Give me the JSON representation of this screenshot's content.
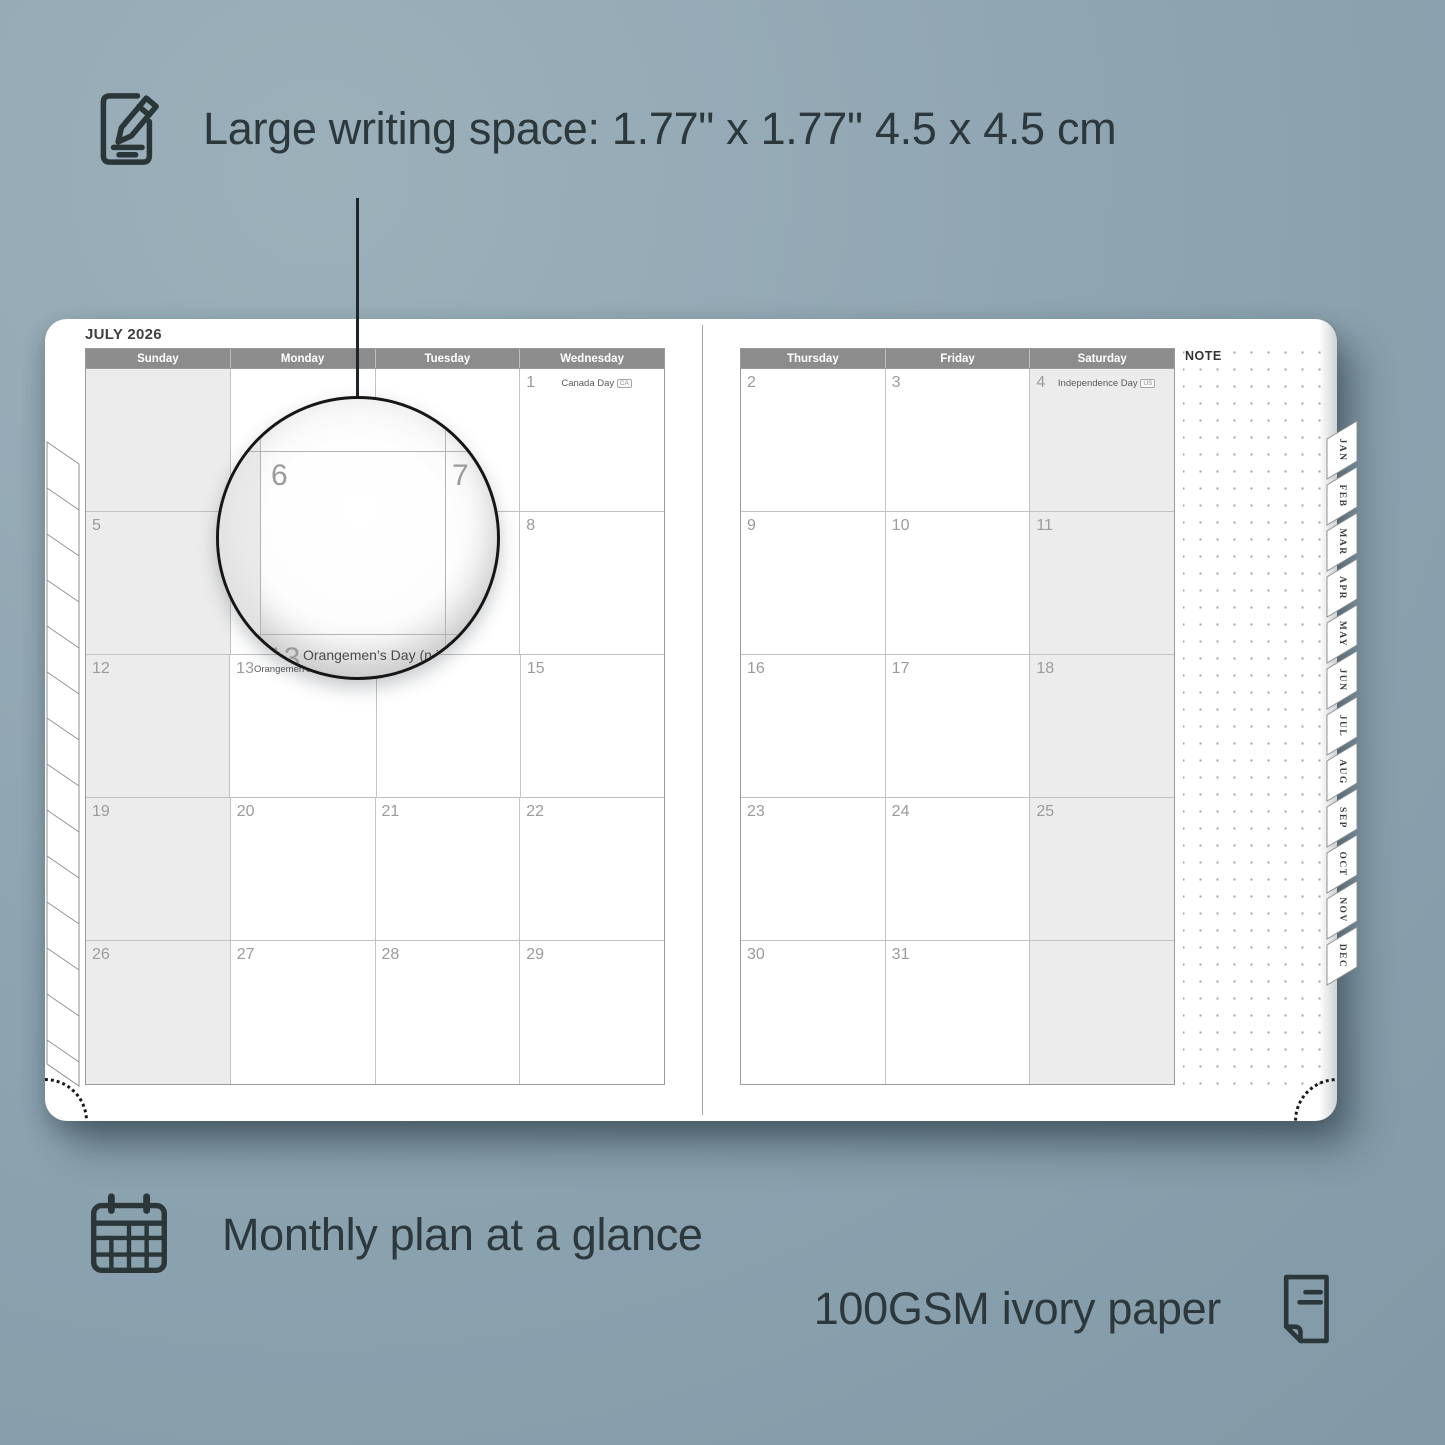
{
  "features": {
    "writing_space_label": "Large writing space: 1.77\" x 1.77\" 4.5 x 4.5 cm",
    "monthly_plan_label": "Monthly plan at a glance",
    "paper_label": "100GSM ivory paper"
  },
  "colors": {
    "background": "#8ba2af",
    "ink": "#2c383c",
    "header_bar": "#8c8c8c",
    "weekend_fill": "#ececec",
    "grid_line": "#c2c2c2",
    "day_number": "#9b9b9b"
  },
  "planner": {
    "month_title": "JULY 2026",
    "note_label": "NOTE",
    "left_day_headers": [
      "Sunday",
      "Monday",
      "Tuesday",
      "Wednesday"
    ],
    "right_day_headers": [
      "Thursday",
      "Friday",
      "Saturday"
    ],
    "month_tabs": [
      "JAN",
      "FEB",
      "MAR",
      "APR",
      "MAY",
      "JUN",
      "JUL",
      "AUG",
      "SEP",
      "OCT",
      "NOV",
      "DEC"
    ],
    "left_grid": [
      [
        {
          "day": ""
        },
        {
          "day": ""
        },
        {
          "day": ""
        },
        {
          "day": "1",
          "holiday": "Canada Day",
          "badge": "CA"
        }
      ],
      [
        {
          "day": "5"
        },
        {
          "day": "6"
        },
        {
          "day": "7"
        },
        {
          "day": "8"
        }
      ],
      [
        {
          "day": "12"
        },
        {
          "day": "13",
          "holiday": "Orangemen’s Day (n.i.)",
          "badge": "UK"
        },
        {
          "day": "14"
        },
        {
          "day": "15"
        }
      ],
      [
        {
          "day": "19"
        },
        {
          "day": "20"
        },
        {
          "day": "21"
        },
        {
          "day": "22"
        }
      ],
      [
        {
          "day": "26"
        },
        {
          "day": "27"
        },
        {
          "day": "28"
        },
        {
          "day": "29"
        }
      ]
    ],
    "right_grid": [
      [
        {
          "day": "2"
        },
        {
          "day": "3"
        },
        {
          "day": "4",
          "holiday": "Independence Day",
          "badge": "US"
        }
      ],
      [
        {
          "day": "9"
        },
        {
          "day": "10"
        },
        {
          "day": "11"
        }
      ],
      [
        {
          "day": "16"
        },
        {
          "day": "17"
        },
        {
          "day": "18"
        }
      ],
      [
        {
          "day": "23"
        },
        {
          "day": "24"
        },
        {
          "day": "25"
        }
      ],
      [
        {
          "day": "30"
        },
        {
          "day": "31"
        },
        {
          "day": ""
        }
      ]
    ],
    "magnifier": {
      "day_main": "6",
      "day_right": "7",
      "day_below": "13",
      "holiday": "Orangemen’s Day (n.i.)",
      "badge": "UK"
    }
  }
}
